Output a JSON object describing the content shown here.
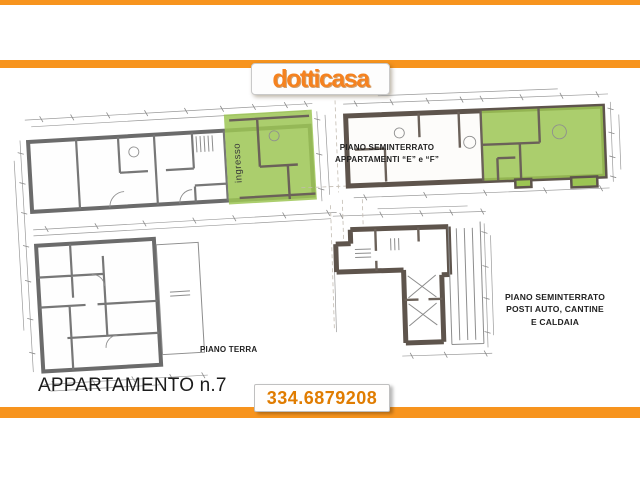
{
  "page": {
    "background": "#ffffff",
    "accent_orange": "#F7941E",
    "highlight_green": "#9CC553"
  },
  "header": {
    "logo_text": "dotticasa"
  },
  "plans": {
    "ground_floor": {
      "caption": "PIANO TERRA",
      "apartment_title": "APPARTAMENTO n.7",
      "highlight_label": "ingresso"
    },
    "basement_apartments": {
      "caption_line1": "PIANO SEMINTERRATO",
      "caption_line2": "APPARTAMENTI “E” e “F”"
    },
    "basement_garage": {
      "caption_line1": "PIANO SEMINTERRATO",
      "caption_line2": "POSTI AUTO, CANTINE",
      "caption_line3": "E CALDAIA"
    }
  },
  "footer": {
    "phone": "334.6879208"
  }
}
